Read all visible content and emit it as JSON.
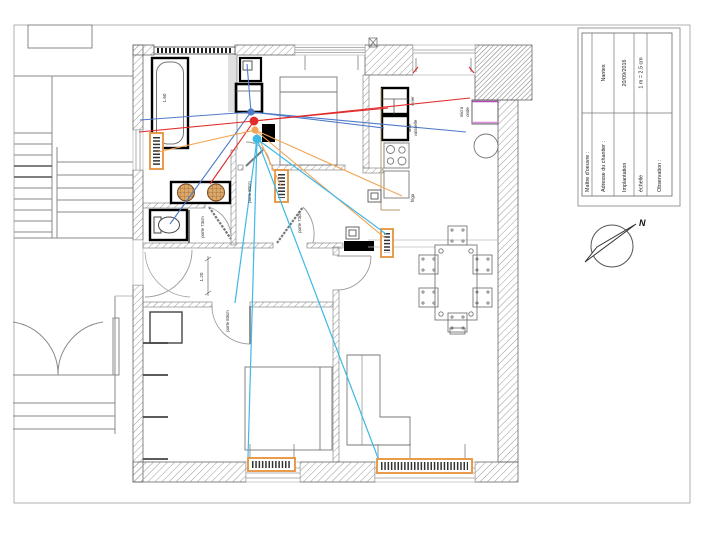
{
  "title_block": {
    "rows": [
      {
        "label": "Maître d'oeuvre :",
        "value": ""
      },
      {
        "label": "Adresse du chantier :",
        "value": "Nantes"
      },
      {
        "label": "Implantation",
        "value": "20/09/2016"
      },
      {
        "label": "échelle",
        "value": "1 m = 2.5 cm"
      },
      {
        "label": "Observation :",
        "value": ""
      }
    ]
  },
  "compass": {
    "label": "N"
  },
  "plan": {
    "dimensions": {
      "bathtub_length": "1.60",
      "hall_width": "1.20"
    },
    "doors": {
      "wc": "porte 73cm",
      "bedroom_top": "porte 80cm",
      "living": "porte 73cm",
      "bedroom_bottom": "porte 83cm"
    },
    "kitchen": {
      "sink": "evier",
      "dishwasher_line1": "lave",
      "dishwasher_line2": "vaisselle",
      "fridge": "frigo",
      "microwave_line1": "micro",
      "microwave_line2": "onde"
    }
  },
  "colors": {
    "cable_red": "#e22b2b",
    "cable_blue": "#4f7bc8",
    "cable_orange": "#f2a556",
    "cable_cyan": "#3fb9e6",
    "radiator_orange": "#e8923a",
    "microwave_top": "#b04ab0",
    "microwave_bottom": "#d98ad9",
    "window_mark_red": "#cc2222"
  }
}
